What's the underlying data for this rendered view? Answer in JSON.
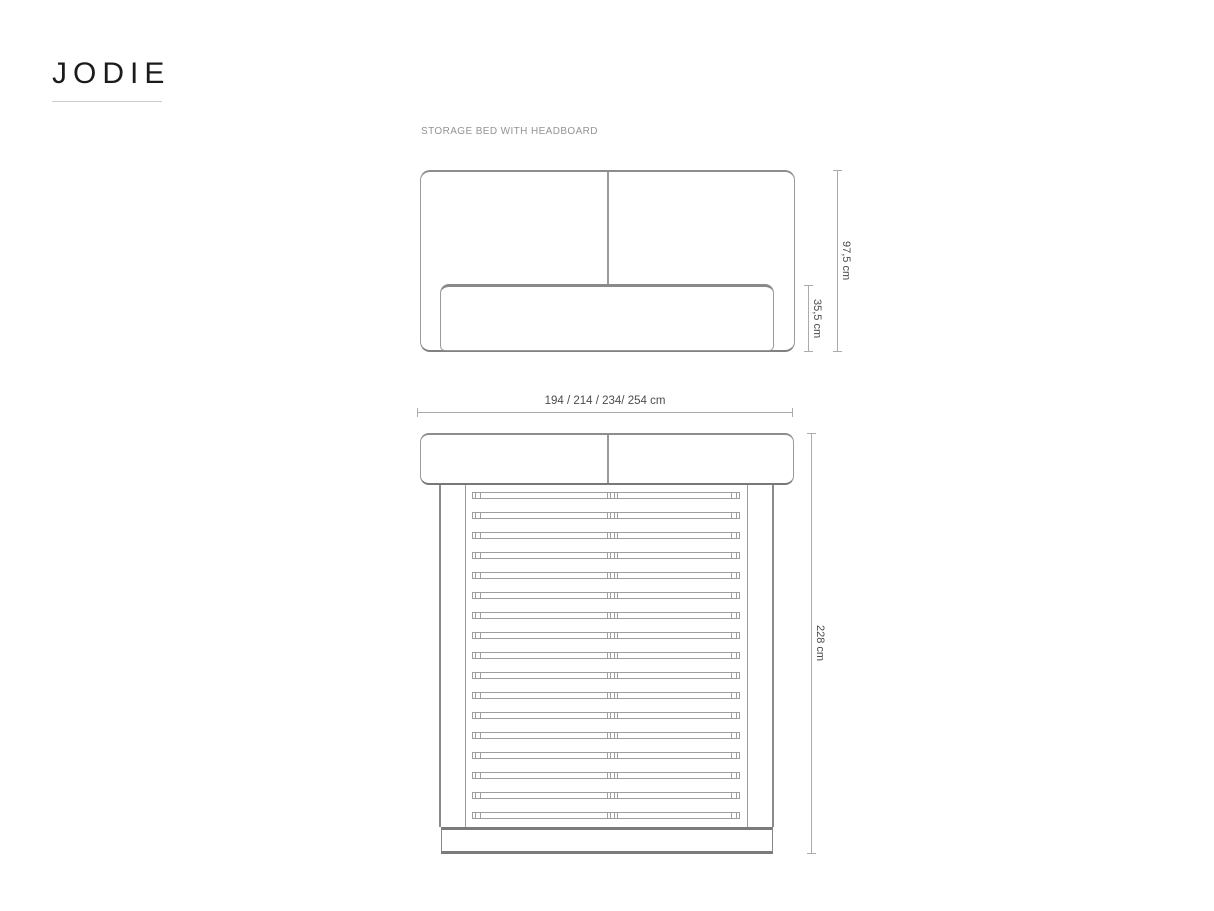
{
  "brand": {
    "logo": "JODIE"
  },
  "drawing": {
    "subtitle": "STORAGE BED WITH HEADBOARD",
    "colors": {
      "line": "#9a9a9a",
      "line_dark": "#7b7b7b",
      "dimension_line": "#ababab",
      "dimension_text": "#4c4c4c",
      "subtitle_text": "#939393",
      "logo_text": "#1b1b1b"
    },
    "front_view": {
      "height_label": "97,5 cm",
      "base_height_label": "35,5 cm",
      "width_label": "194 / 214 / 234/ 254 cm"
    },
    "top_view": {
      "length_label": "228 cm",
      "slat_rows": 17
    }
  }
}
